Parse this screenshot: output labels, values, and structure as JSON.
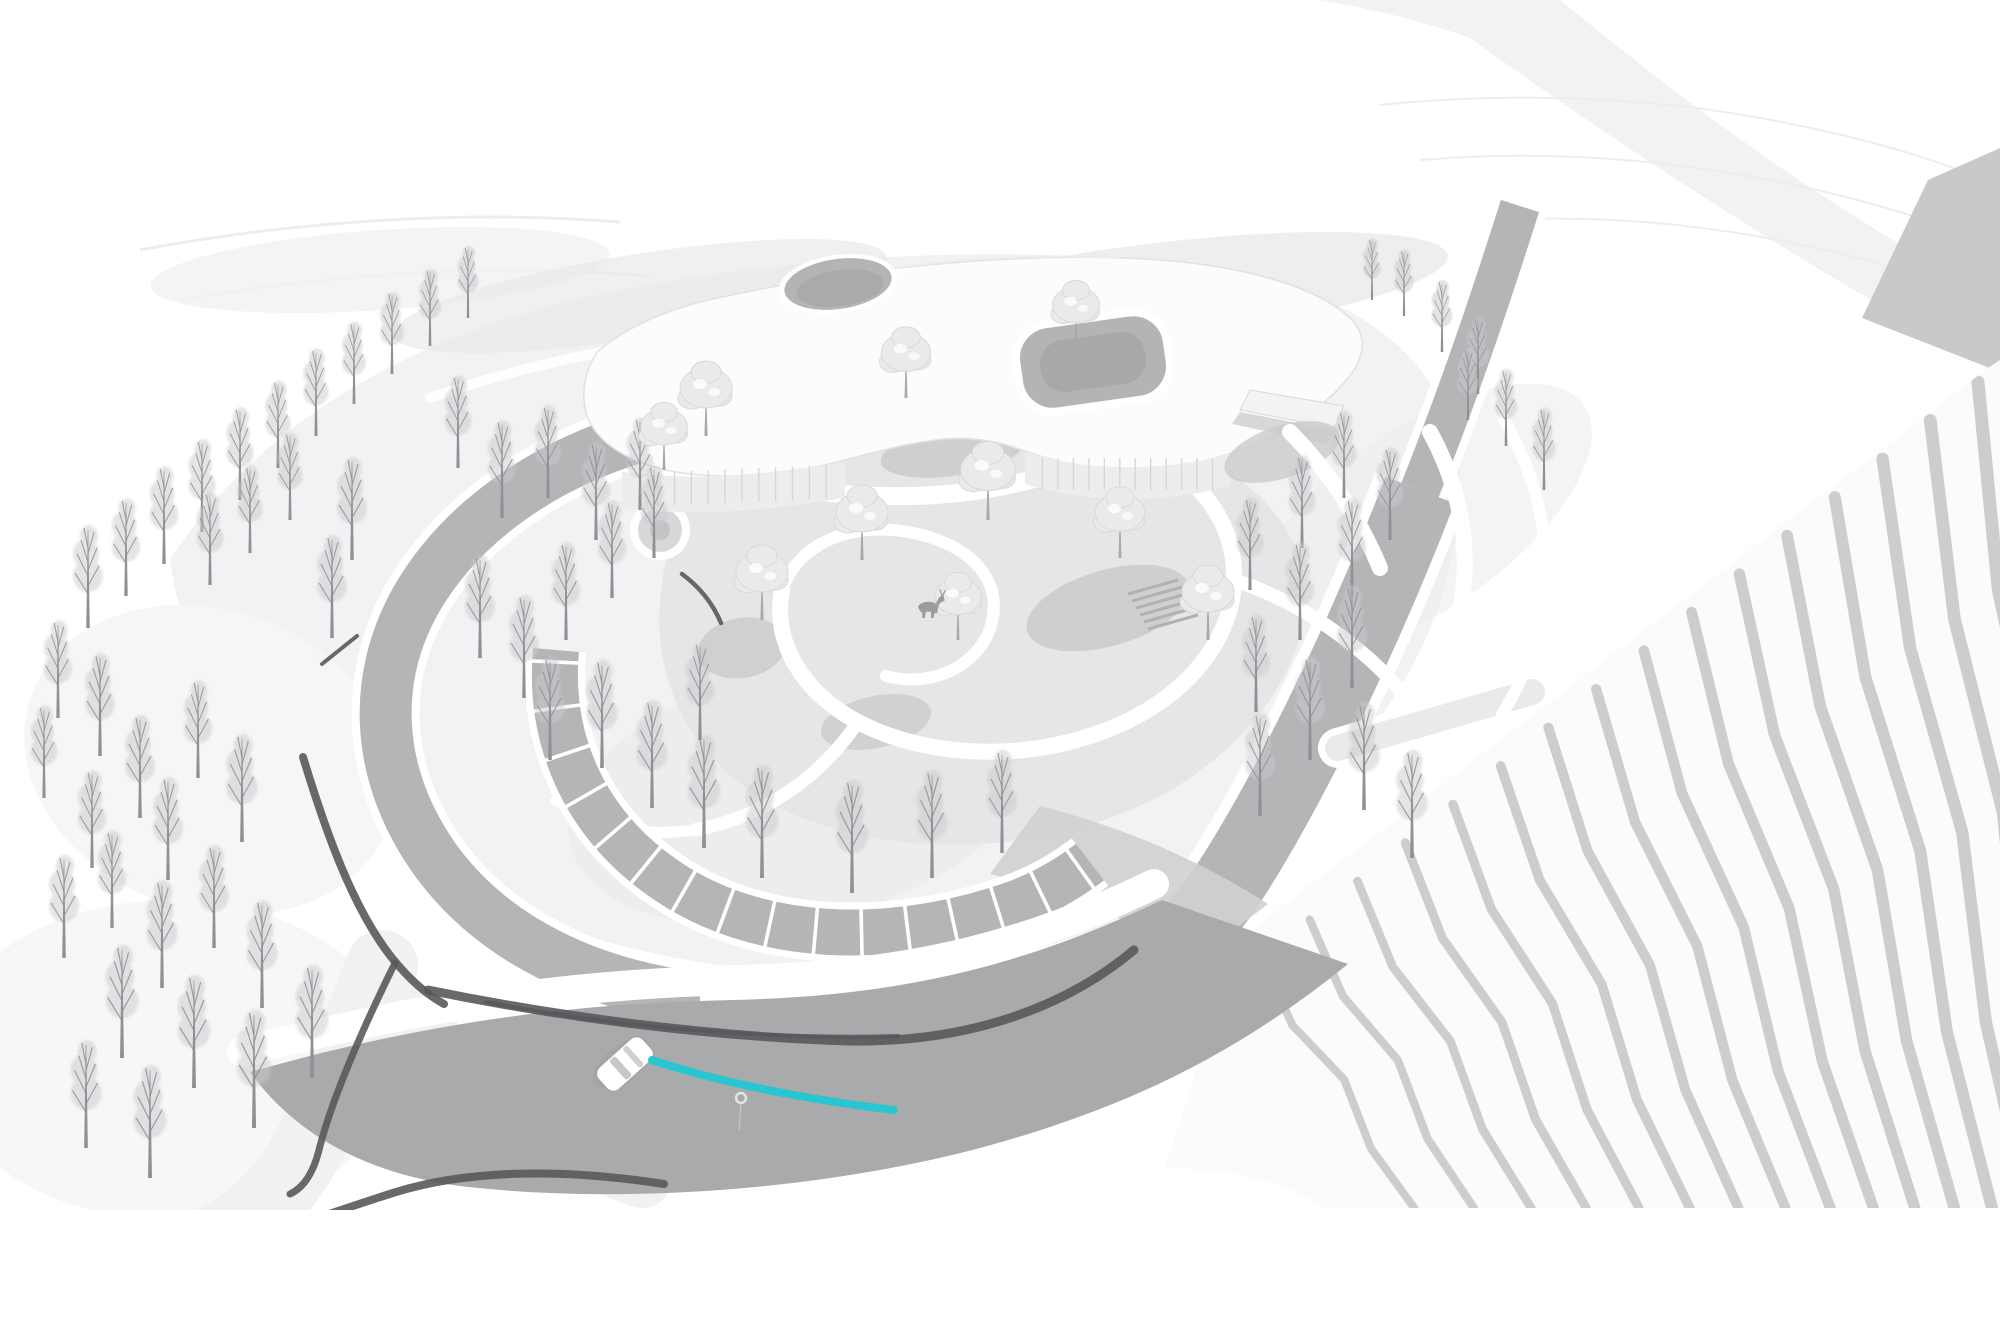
{
  "scene": {
    "type": "architectural-aerial-site-rendering",
    "palette": {
      "bg": "#ffffff",
      "ground-pale": "#f1f2f3",
      "ground-mid": "#e3e4e6",
      "patch": "#c9cacc",
      "road": "#a9aaac",
      "road-light": "#b4b5b7",
      "sketch": "#58595b",
      "accent": "#27c6d1",
      "tree-trunk": "#909194",
      "tree-haze": "#c9cacd",
      "leafy-fill": "#e9eaec",
      "terrace-stripe": "#c8c9cb",
      "building-line": "#d6d7d9",
      "building-face": "#eceded",
      "court-floor": "#b3b4b6"
    },
    "trees": {
      "bare": [
        [
          88,
          628,
          1.0
        ],
        [
          126,
          596,
          0.95
        ],
        [
          164,
          564,
          0.95
        ],
        [
          202,
          532,
          0.9
        ],
        [
          240,
          500,
          0.9
        ],
        [
          278,
          468,
          0.85
        ],
        [
          316,
          436,
          0.85
        ],
        [
          354,
          404,
          0.8
        ],
        [
          392,
          374,
          0.8
        ],
        [
          430,
          346,
          0.75
        ],
        [
          468,
          318,
          0.7
        ],
        [
          210,
          585,
          0.9
        ],
        [
          250,
          553,
          0.85
        ],
        [
          290,
          520,
          0.85
        ],
        [
          58,
          718,
          0.95
        ],
        [
          100,
          756,
          1.0
        ],
        [
          44,
          798,
          0.9
        ],
        [
          140,
          818,
          1.0
        ],
        [
          198,
          778,
          0.95
        ],
        [
          242,
          842,
          1.05
        ],
        [
          168,
          880,
          1.0
        ],
        [
          92,
          868,
          0.95
        ],
        [
          64,
          958,
          1.0
        ],
        [
          112,
          928,
          0.95
        ],
        [
          162,
          988,
          1.05
        ],
        [
          214,
          948,
          1.0
        ],
        [
          262,
          1008,
          1.05
        ],
        [
          122,
          1058,
          1.1
        ],
        [
          194,
          1088,
          1.1
        ],
        [
          254,
          1128,
          1.15
        ],
        [
          312,
          1078,
          1.1
        ],
        [
          86,
          1148,
          1.05
        ],
        [
          150,
          1178,
          1.1
        ],
        [
          352,
          560,
          1.0
        ],
        [
          332,
          638,
          1.0
        ],
        [
          458,
          468,
          0.9
        ],
        [
          502,
          518,
          0.95
        ],
        [
          548,
          498,
          0.9
        ],
        [
          596,
          540,
          0.95
        ],
        [
          640,
          510,
          0.9
        ],
        [
          480,
          658,
          1.0
        ],
        [
          524,
          698,
          1.0
        ],
        [
          566,
          640,
          0.95
        ],
        [
          612,
          598,
          0.95
        ],
        [
          654,
          558,
          0.9
        ],
        [
          602,
          768,
          1.05
        ],
        [
          652,
          808,
          1.05
        ],
        [
          704,
          848,
          1.1
        ],
        [
          762,
          878,
          1.1
        ],
        [
          852,
          893,
          1.1
        ],
        [
          932,
          878,
          1.05
        ],
        [
          1002,
          853,
          1.0
        ],
        [
          700,
          740,
          0.95
        ],
        [
          550,
          760,
          1.0
        ],
        [
          1344,
          498,
          0.85
        ],
        [
          1390,
          540,
          0.9
        ],
        [
          1302,
          548,
          0.9
        ],
        [
          1352,
          596,
          0.95
        ],
        [
          1250,
          590,
          0.9
        ],
        [
          1300,
          640,
          0.95
        ],
        [
          1352,
          688,
          1.0
        ],
        [
          1256,
          712,
          0.95
        ],
        [
          1310,
          760,
          1.0
        ],
        [
          1364,
          810,
          1.05
        ],
        [
          1412,
          858,
          1.05
        ],
        [
          1260,
          816,
          1.0
        ],
        [
          1404,
          316,
          0.65
        ],
        [
          1442,
          352,
          0.7
        ],
        [
          1478,
          394,
          0.75
        ],
        [
          1372,
          300,
          0.6
        ],
        [
          1506,
          446,
          0.75
        ],
        [
          1544,
          490,
          0.8
        ],
        [
          1468,
          420,
          0.7
        ]
      ],
      "leafy": [
        [
          706,
          436,
          1.0
        ],
        [
          906,
          398,
          0.95
        ],
        [
          1076,
          348,
          0.9
        ],
        [
          988,
          520,
          1.05
        ],
        [
          862,
          560,
          1.0
        ],
        [
          762,
          620,
          1.0
        ],
        [
          1120,
          558,
          0.95
        ],
        [
          1208,
          640,
          1.0
        ],
        [
          664,
          470,
          0.9
        ],
        [
          958,
          640,
          0.9
        ]
      ]
    },
    "parking": {
      "stall_count": 15
    },
    "terraces": {
      "stripe_count": 16
    },
    "building": {
      "facade_mullions": 13
    },
    "car": {
      "x": 625,
      "y": 1064,
      "rotation": 138,
      "color": "#ffffff"
    },
    "route_line": {
      "x1": 652,
      "y1": 1060,
      "x2": 894,
      "y2": 1110
    },
    "road_marker": {
      "x": 741,
      "y": 1098
    },
    "deer": {
      "x": 916,
      "y": 618
    }
  }
}
